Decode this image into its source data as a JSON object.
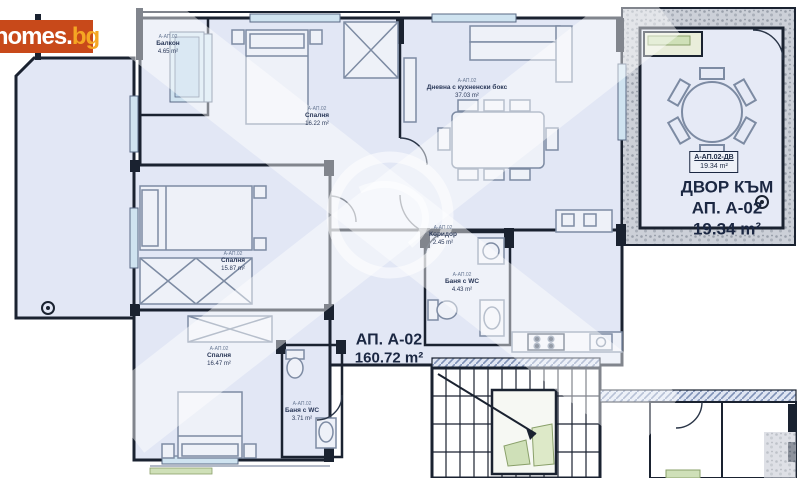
{
  "logo": {
    "main": "homes.",
    "suffix": "bg"
  },
  "apartment": {
    "title": "АП. А-02",
    "area": "160.72 m²"
  },
  "yard": {
    "tag_code": "А-АП.02-ДВ",
    "tag_area": "19.34 m²",
    "line1": "ДВОР КЪМ",
    "line2": "АП. А-02",
    "line3": "19.34 m²"
  },
  "rooms": [
    {
      "id": "balcony-top-left",
      "code": "А-АП.02",
      "name": "Балкон",
      "area": "4.65 m²"
    },
    {
      "id": "bedroom-top",
      "code": "А-АП.02",
      "name": "Спалня",
      "area": "16.22 m²"
    },
    {
      "id": "living-room",
      "code": "А-АП.02",
      "name": "Дневна с кухненски бокс",
      "area": "37.03 m²"
    },
    {
      "id": "bedroom-middle",
      "code": "А-АП.02",
      "name": "Спалня",
      "area": "15.87 m²"
    },
    {
      "id": "bedroom-bottom",
      "code": "А-АП.02",
      "name": "Спалня",
      "area": "16.47 m²"
    },
    {
      "id": "bathroom-1",
      "code": "А-АП.02",
      "name": "Баня с WC",
      "area": "4.43 m²"
    },
    {
      "id": "bathroom-2",
      "code": "А-АП.02",
      "name": "Баня с WC",
      "area": "3.71 m²"
    },
    {
      "id": "corridor",
      "code": "А-АП.02",
      "name": "Коридор",
      "area": "2.45 m²"
    }
  ],
  "colors": {
    "logo_bg": "#c8491a",
    "logo_suffix": "#f5a623",
    "floor": "#e2e7f5",
    "wall": "#1a2230",
    "furniture": "#7d8ba3",
    "window": "#cfe3f0",
    "green": "#cfe0b8",
    "text": "#1b2742"
  }
}
